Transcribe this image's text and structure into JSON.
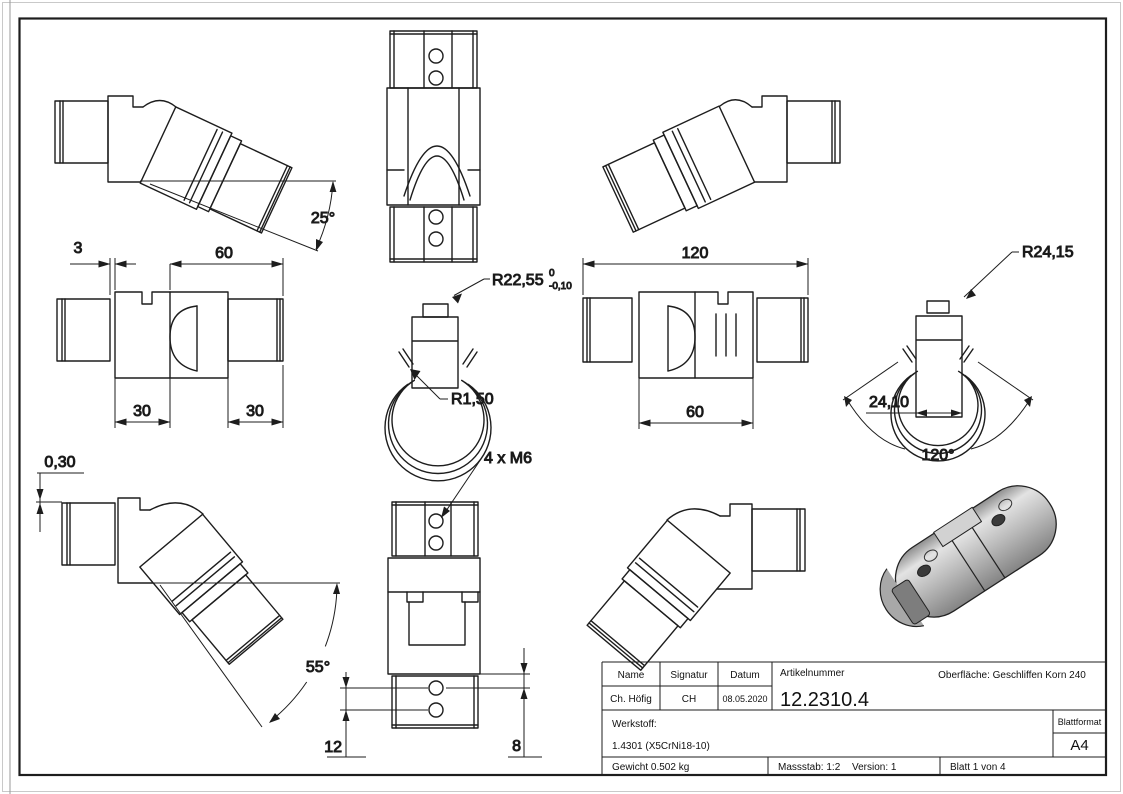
{
  "sheet": {
    "dims": {
      "angle_25": "25°",
      "len_3": "3",
      "len_60_top": "60",
      "len_30_a": "30",
      "len_30_b": "30",
      "rad_r2255": "R22,55",
      "rad_r2255_tol_upper": "0",
      "rad_r2255_tol_lower": "-0,10",
      "rad_r150": "R1,50",
      "len_120": "120",
      "len_60_bottom": "60",
      "rad_r2415": "R24,15",
      "len_2410": "24,10",
      "angle_120": "120°",
      "len_030": "0,30",
      "angle_55": "55°",
      "thread_note": "4 x M6",
      "len_12": "12",
      "len_8": "8"
    },
    "title_block": {
      "name_label": "Name",
      "name_value": "Ch. Höfig",
      "signatur_label": "Signatur",
      "signatur_value": "CH",
      "datum_label": "Datum",
      "datum_value": "08.05.2020",
      "artikelnummer_label": "Artikelnummer",
      "artikelnummer_value": "12.2310.4",
      "oberflaeche_label": "Oberfläche:  Geschliffen Korn 240",
      "werkstoff_label": "Werkstoff:",
      "werkstoff_value": "1.4301 (X5CrNi18-10)",
      "blattformat_label": "Blattformat",
      "blattformat_value": "A4",
      "gewicht_label": "Gewicht 0.502 kg",
      "massstab_label": "Massstab: 1:2",
      "version_label": "Version: 1",
      "blatt_label": "Blatt 1 von 4"
    }
  }
}
